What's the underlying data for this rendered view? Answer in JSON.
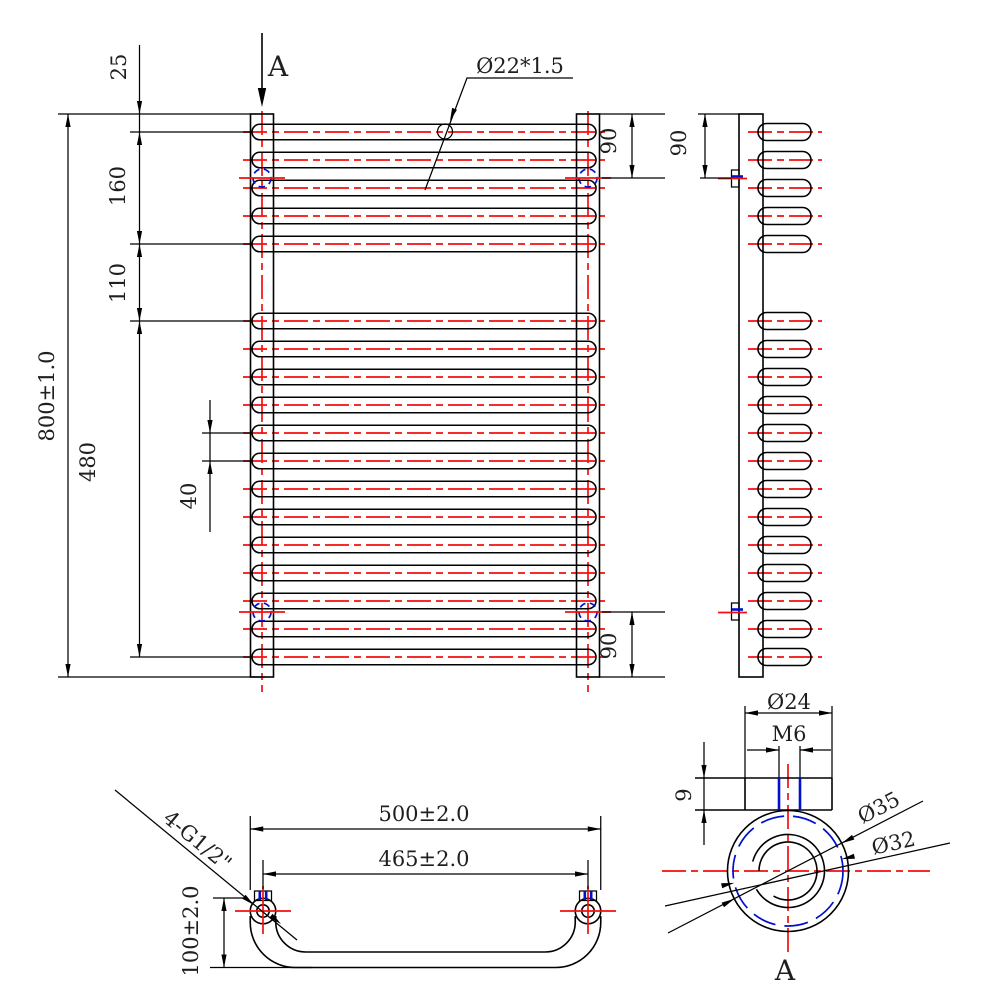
{
  "drawing_title": "Towel radiator three-view engineering drawing",
  "colors": {
    "background": "#ffffff",
    "line": "#000000",
    "centerline": "#f50f0f",
    "accent_blue": "#0011cc",
    "text": "#1f1f1f"
  },
  "front_view": {
    "section_label": "A",
    "tube_callout": "Ø22*1.5",
    "dim_top_offset": "25",
    "dim_upper_group": "160",
    "dim_gap": "110",
    "dim_lower_group": "480",
    "dim_pitch": "40",
    "dim_overall_height": "800±1.0",
    "dim_mount_top": "90",
    "dim_mount_bottom": "90",
    "bars": {
      "top_count": 5,
      "top_first_y": 132,
      "bottom_count": 13,
      "bottom_first_y": 321,
      "pitch_px": 28
    }
  },
  "side_view": {
    "dim_mount_top": "90"
  },
  "bottom_view": {
    "dim_outer_width": "500±2.0",
    "dim_center_distance": "465±2.0",
    "dim_depth": "100±2.0",
    "thread_callout": "4-G1/2\""
  },
  "detail_view": {
    "section_label": "A",
    "dim_bracket_dia": "Ø24",
    "dim_thread": "M6",
    "dim_plate_thickness": "9",
    "dim_outer_dia": "Ø35",
    "dim_mid_dia": "Ø32"
  }
}
